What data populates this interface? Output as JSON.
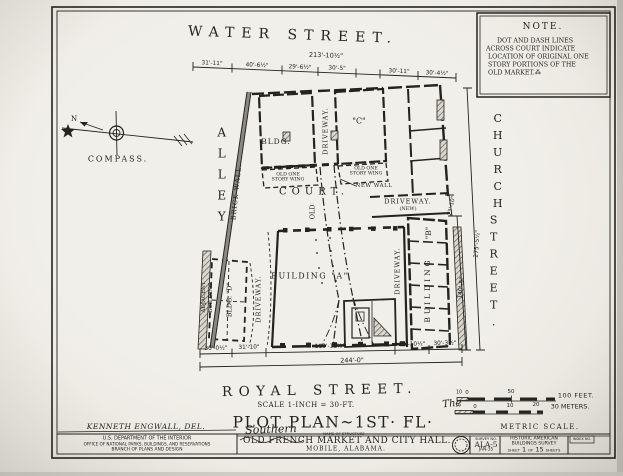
{
  "colors": {
    "paper": "#eeece5",
    "ink": "#23231f"
  },
  "note": {
    "title": "NOTE.",
    "line1": "DOT AND DASH LINES",
    "line2": "ACROSS COURT INDICATE",
    "line3": "LOCATION OF ORIGINAL ONE",
    "line4": "STORY PORTIONS OF THE",
    "line5": "OLD MARKET.⁂"
  },
  "compass": {
    "label": "COMPASS.",
    "north": "N"
  },
  "streets": {
    "water": "WATER STREET.",
    "royal": "ROYAL STREET.",
    "church_line1": "CHURCH",
    "church_line2": "STREET.",
    "alley": "ALLEY",
    "brick_wall": "BRICK WALL.",
    "adjacent_line1": "ADJACENT",
    "adjacent_line2": "BUILDING."
  },
  "plan": {
    "bldg_c_word": "BLDG.",
    "bldg_c_letter": "\"C\"",
    "building_a": "BUILDING \"A\"",
    "building_b_word": "BUILDING",
    "building_b_letter": "\"B\"",
    "bldg_d": "BLDG. \"D\"",
    "court": "COURT.",
    "old": "OLD",
    "driveway_north": "DRIVEWAY.",
    "driveway_west": "DRIVEWAY.",
    "driveway_east": "DRIVEWAY.",
    "driveway_new_word": "DRIVEWAY.",
    "driveway_new_tag": "(NEW)",
    "new_wall": "NEW WALL",
    "wing_left_line1": "OLD ONE",
    "wing_left_line2": "STORY WING",
    "wing_right_line1": "OLD ONE",
    "wing_right_line2": "STORY WING"
  },
  "dims": {
    "top_overall": "213'-10½\"",
    "top1": "31'-11\"",
    "top2": "40'-6½\"",
    "top3": "29'-6½\"",
    "top4": "30'-5\"",
    "top5": "30'-11\"",
    "top6": "30'-4½\"",
    "bottom1": "30'-0½\"",
    "bottom2": "31'-10\"",
    "bottom3": "119'-11½\"",
    "bottom4": "31'-10½\"",
    "bottom5": "30'-3½\"",
    "bottom_overall": "244'-0\"",
    "right_driveway": "23'-10\"",
    "right_overall": "275'-5½\"",
    "right_building": "140'-5\""
  },
  "titles": {
    "scale_note": "SCALE 1-INCH = 30-FT.",
    "plot_plan": "PLOT PLAN~1ST· FL·"
  },
  "scalebars": {
    "feet_10": "10",
    "feet_0": "0",
    "feet_50": "50",
    "feet_100": "100 FEET.",
    "m_10left": "10",
    "m_0": "0",
    "m_10": "10",
    "m_20": "20",
    "m_30": "30 METERS.",
    "metric_label": "METRIC SCALE."
  },
  "titleblock": {
    "delineator": "KENNETH ENGWALL, DEL.",
    "dept1": "U.S. DEPARTMENT OF THE INTERIOR",
    "dept2": "OFFICE OF NATIONAL PARKS, BUILDINGS, AND RESERVATIONS",
    "dept3": "BRANCH OF PLANS AND DESIGN",
    "script_the": "The",
    "script_southern": "Southern",
    "name_caption": "NAME OF STRUCTURE",
    "structure_name": "OLD FRENCH MARKET AND CITY HALL.",
    "location": "MOBILE, ALABAMA.",
    "survey_label": "SURVEY NO.",
    "survey_no": "ALA-5",
    "survey_date": "JAN-35",
    "habs_line1": "HISTORIC AMERICAN",
    "habs_line2": "BUILDINGS SURVEY",
    "sheet_word": "SHEET",
    "sheet_num": "1",
    "sheet_of": "OF",
    "sheet_total": "15",
    "sheet_word2": "SHEETS",
    "index_label": "INDEX NO."
  }
}
